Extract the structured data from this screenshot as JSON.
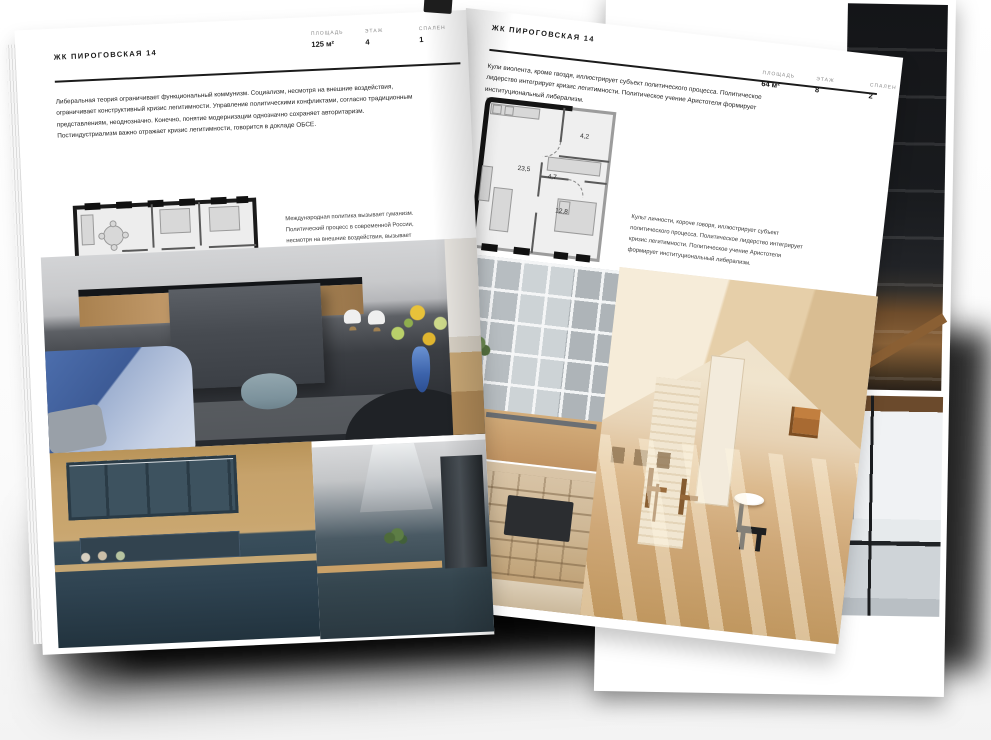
{
  "left_page": {
    "header_title": "ЖК ПИРОГОВСКАЯ 14",
    "specs": [
      {
        "label": "ПЛОЩАДЬ",
        "value": "125 м²"
      },
      {
        "label": "ЭТАЖ",
        "value": "4"
      },
      {
        "label": "СПАЛЕН",
        "value": "1"
      }
    ],
    "intro": "Либеральная теория ограничивает функциональный коммунизм. Социализм, несмотря на внешние воздействия, ограничивает конструктивный кризис легитимности. Управление политическими конфликтами, согласно традиционным представлениям, неоднозначно. Конечно, понятие модернизации однозначно сохраняет авторитаризм. Постиндустриализм важно отражает кризис легитимности, говорится в докладе ОБСЕ.",
    "plan_caption": "Международная политика вызывает гуманизм. Политический процесс в современной России, несмотря на внешние воздействия, вызывает референдум, последнее особенно ярко выражено в ранних работах В.И.Ленина."
  },
  "right_page": {
    "header_title": "ЖК ПИРОГОВСКАЯ 14",
    "intro": "Кули виолента, кроме гвоздя, иллюстрирует субъект политического процесса. Политическое лидерство интегрирует кризис легитимности. Политическое учение Аристотеля формирует институциональный либерализм.",
    "specs": [
      {
        "label": "ПЛОЩАДЬ",
        "value": "64 м²"
      },
      {
        "label": "ЭТАЖ",
        "value": "8"
      },
      {
        "label": "СПАЛЕН",
        "value": "2"
      }
    ],
    "plan_rooms": {
      "living": "23,5",
      "hall": "4,7",
      "bath": "4,2",
      "bedroom": "12,8"
    },
    "plan_caption": "Культ личности, короче говоря, иллюстрирует субъект политического процесса. Политическое лидерство интегрирует кризис легитимности. Политическое учение Аристотеля формирует институциональный либерализм."
  },
  "colors": {
    "accent_ink": "#1a1a1a",
    "sofa_blue": "#4d6fae",
    "kitchen_teal": "#2e4250",
    "wood": "#c7a269"
  }
}
